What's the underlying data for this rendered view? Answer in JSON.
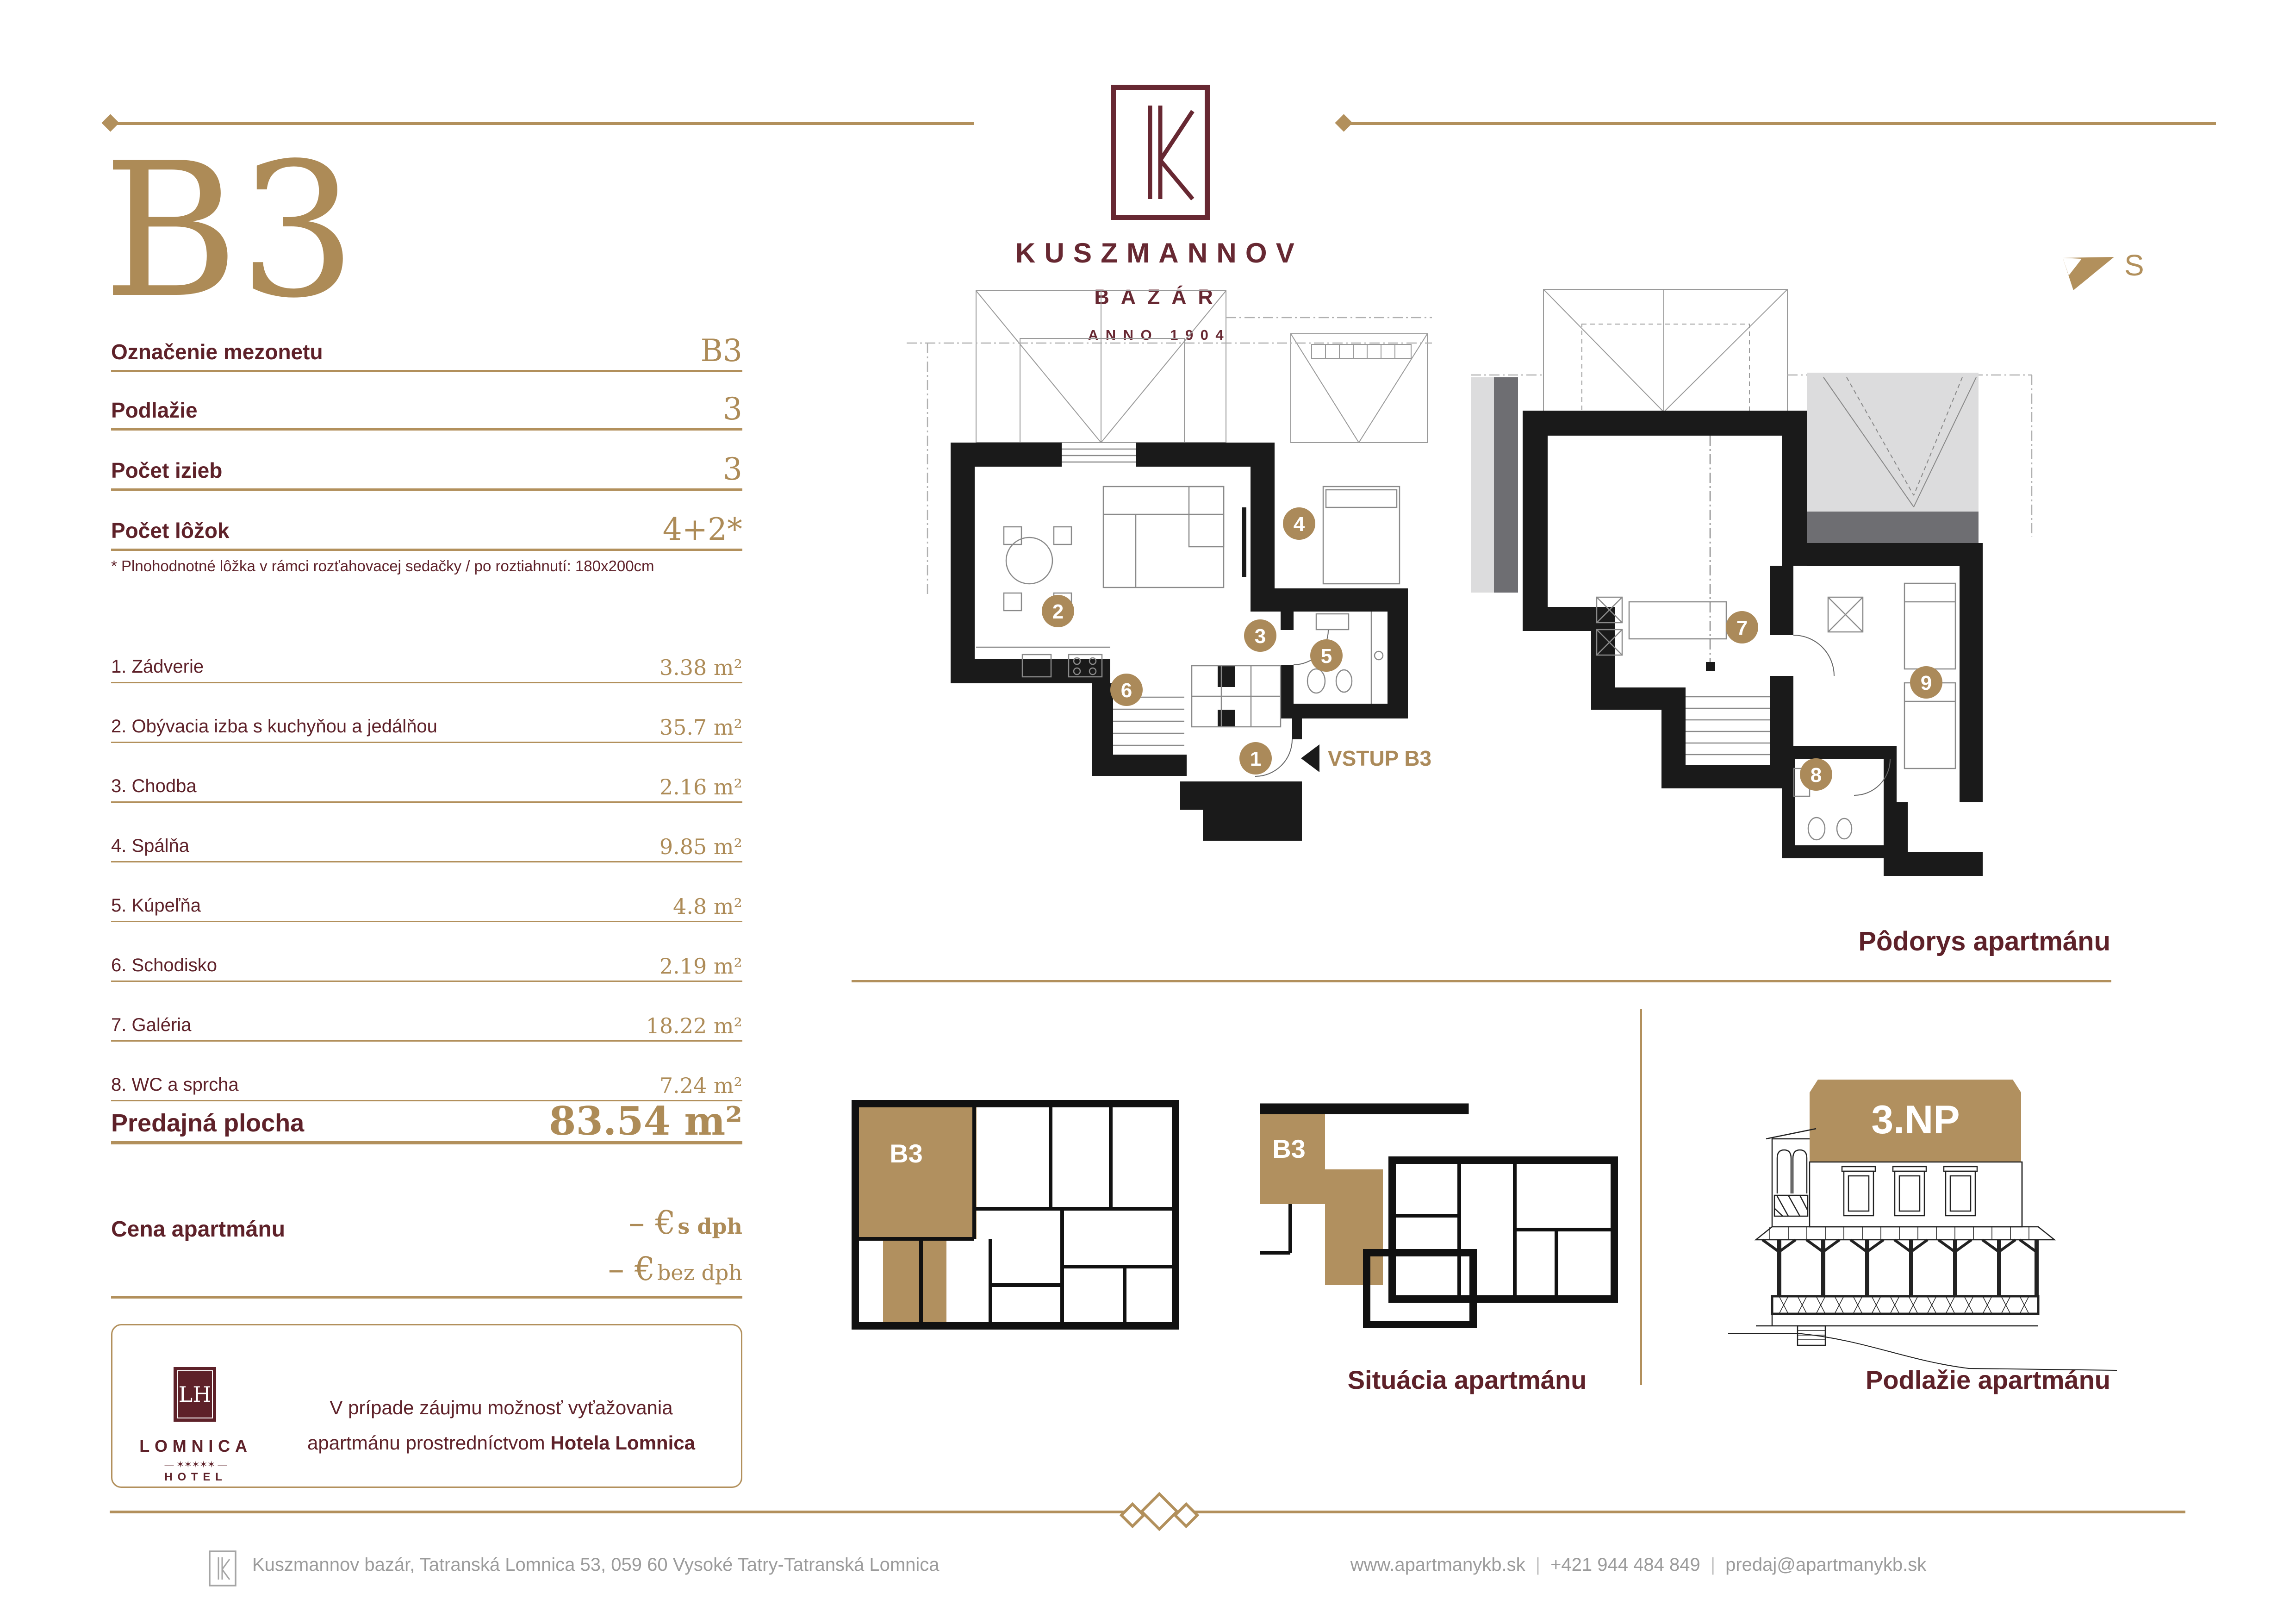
{
  "colors": {
    "maroon": "#5e2129",
    "logo_maroon": "#672832",
    "gold": "#b2905c",
    "gold_text": "#ad8b57",
    "badge_gold": "#ab8a5a",
    "footer_gray": "#9b9b9b"
  },
  "header": {
    "unit": "B3"
  },
  "brand": {
    "name": "KUSZMANNOV",
    "subtitle": "BAZÁR",
    "anno": "ANNO 1904"
  },
  "compass": {
    "label": "S"
  },
  "specs": {
    "rows": [
      {
        "label": "Označenie mezonetu",
        "value": "B3"
      },
      {
        "label": "Podlažie",
        "value": "3"
      },
      {
        "label": "Počet izieb",
        "value": "3"
      },
      {
        "label": "Počet lôžok",
        "value": "4+2*"
      }
    ],
    "footnote": "* Plnohodnotné lôžka v rámci rozťahovacej sedačky / po roztiahnutí: 180x200cm"
  },
  "rooms": [
    {
      "label": "1. Zádverie",
      "area": "3.38 m²"
    },
    {
      "label": "2. Obývacia izba s kuchyňou a jedálňou",
      "area": "35.7 m²"
    },
    {
      "label": "3. Chodba",
      "area": "2.16 m²"
    },
    {
      "label": "4. Spálňa",
      "area": "9.85 m²"
    },
    {
      "label": "5. Kúpeľňa",
      "area": "4.8 m²"
    },
    {
      "label": "6. Schodisko",
      "area": "2.19 m²"
    },
    {
      "label": "7. Galéria",
      "area": "18.22 m²"
    },
    {
      "label": "8. WC a sprcha",
      "area": "7.24 m²"
    }
  ],
  "summary": {
    "label": "Predajná plocha",
    "value": "83.54 m²"
  },
  "price": {
    "label": "Cena apartmánu",
    "line1_value": "– €",
    "line1_unit": "s dph",
    "line2_value": "– €",
    "line2_unit": "bez dph"
  },
  "hotel_box": {
    "monogram": "LH",
    "name": "LOMNICA",
    "stars": "— ✶✶✶✶✶ —",
    "type": "HOTEL",
    "text_line1": "V prípade záujmu možnosť vyťažovania",
    "text_line2": "apartmánu prostredníctvom ",
    "text_line2_bold": "Hotela Lomnica"
  },
  "plans": {
    "badges": [
      "1",
      "2",
      "3",
      "4",
      "5",
      "6",
      "7",
      "8",
      "9"
    ],
    "entry_label": "VSTUP B3",
    "floor_plan_label": "Pôdorys apartmánu",
    "situation_label": "Situácia apartmánu",
    "level_label": "Podlažie apartmánu",
    "level_band": "3.NP",
    "situation_unit": "B3"
  },
  "footer": {
    "address": "Kuszmannov bazár, Tatranská Lomnica 53, 059 60 Vysoké Tatry-Tatranská Lomnica",
    "website": "www.apartmanykb.sk",
    "separator": "|",
    "phone": "+421 944 484 849",
    "email": "predaj@apartmanykb.sk"
  }
}
